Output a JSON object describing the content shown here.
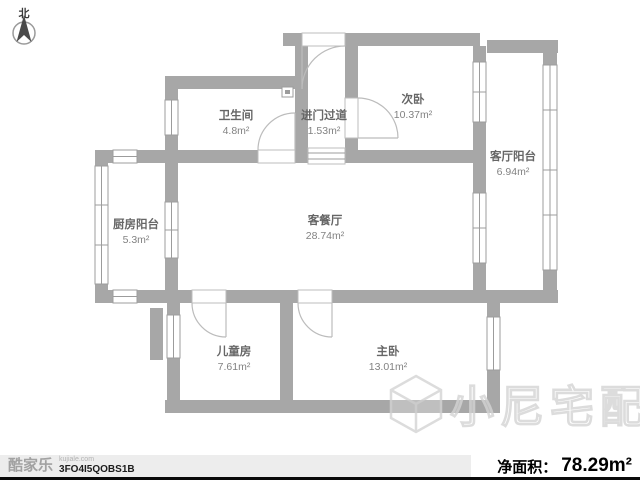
{
  "north": {
    "label": "北"
  },
  "rooms": {
    "bathroom": {
      "name": "卫生间",
      "area": "4.8m²"
    },
    "entry_hall": {
      "name": "进门过道",
      "area": "1.53m²"
    },
    "second_bedroom": {
      "name": "次卧",
      "area": "10.37m²"
    },
    "living_balcony": {
      "name": "客厅阳台",
      "area": "6.94m²"
    },
    "kitchen_balcony": {
      "name": "厨房阳台",
      "area": "5.3m²"
    },
    "living_dining": {
      "name": "客餐厅",
      "area": "28.74m²"
    },
    "kids_room": {
      "name": "儿童房",
      "area": "7.61m²"
    },
    "master_bedroom": {
      "name": "主卧",
      "area": "13.01m²"
    }
  },
  "watermark": {
    "text": "小尼宅配"
  },
  "footer": {
    "brand": "酷家乐",
    "brand_site": "kujiale.com",
    "plan_code": "3FO4I5QOBS1B",
    "net_area_label": "净面积：",
    "net_area_value": "78.29m²"
  },
  "colors": {
    "wall": "#a7a7a7",
    "label_text": "#666666",
    "area_text": "#828282",
    "watermark": "#d4d4d4",
    "footer_bg": "#ededed",
    "footer_line": "#0a0a0a"
  }
}
